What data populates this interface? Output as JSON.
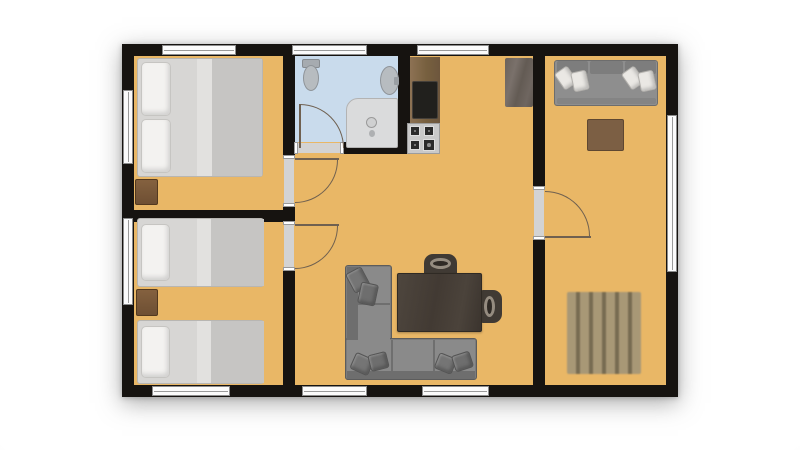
{
  "canvas": {
    "width": 800,
    "height": 450,
    "background": "#ffffff"
  },
  "palette": {
    "wall": "#161310",
    "floor": "#e9b766",
    "bathroom_floor": "#c9dbec",
    "door_line": "#6f6050",
    "window_fill": "#fbfbfb",
    "window_frame": "#8c8c8c",
    "sofa_gray": "#7c7c7c",
    "bed_gray": "#d7d6d4",
    "wood_brown": "#7c5f44"
  },
  "rooms": [
    "bedroom-double",
    "bedroom-twin",
    "bathroom",
    "kitchen-living-room",
    "lounge-room"
  ],
  "elements": [
    {
      "n": "outer-wall",
      "x": 122,
      "y": 44,
      "w": 556,
      "h": 353,
      "bg": "#161310",
      "cls": "plan-shadow"
    },
    {
      "n": "floor",
      "x": 134,
      "y": 56,
      "w": 532,
      "h": 329,
      "bg": "#e9b766"
    },
    {
      "n": "bathroom-floor",
      "x": 295,
      "y": 56,
      "w": 103,
      "h": 86,
      "bg": "#c9dbec"
    },
    {
      "n": "wall-bedrooms-top-seg",
      "x": 283,
      "y": 56,
      "w": 12,
      "h": 101,
      "bg": "#161310"
    },
    {
      "n": "wall-bedrooms-mid-seg",
      "x": 283,
      "y": 205,
      "w": 12,
      "h": 18,
      "bg": "#161310"
    },
    {
      "n": "wall-bedrooms-bottom-seg",
      "x": 283,
      "y": 269,
      "w": 12,
      "h": 116,
      "bg": "#161310"
    },
    {
      "n": "wall-bedroom-divider",
      "x": 134,
      "y": 210,
      "w": 149,
      "h": 12,
      "bg": "#161310"
    },
    {
      "n": "wall-bathroom-right",
      "x": 398,
      "y": 56,
      "w": 12,
      "h": 98,
      "bg": "#161310"
    },
    {
      "n": "wall-bathroom-bottom",
      "x": 342,
      "y": 142,
      "w": 56,
      "h": 12,
      "bg": "#161310"
    },
    {
      "n": "wall-lounge-top-seg",
      "x": 533,
      "y": 56,
      "w": 12,
      "h": 131,
      "bg": "#161310"
    },
    {
      "n": "wall-lounge-bottom-seg",
      "x": 533,
      "y": 240,
      "w": 12,
      "h": 145,
      "bg": "#161310"
    },
    {
      "n": "window-top-bedroom1",
      "x": 162,
      "y": 45,
      "w": 74,
      "h": 10,
      "cls": "window-h"
    },
    {
      "n": "window-top-bathroom",
      "x": 292,
      "y": 45,
      "w": 75,
      "h": 10,
      "cls": "window-h"
    },
    {
      "n": "window-top-kitchen",
      "x": 417,
      "y": 45,
      "w": 72,
      "h": 10,
      "cls": "window-h"
    },
    {
      "n": "window-bottom-bedroom2",
      "x": 152,
      "y": 386,
      "w": 78,
      "h": 10,
      "cls": "window-h"
    },
    {
      "n": "window-bottom-living-1",
      "x": 302,
      "y": 386,
      "w": 65,
      "h": 10,
      "cls": "window-h"
    },
    {
      "n": "window-bottom-living-2",
      "x": 422,
      "y": 386,
      "w": 67,
      "h": 10,
      "cls": "window-h"
    },
    {
      "n": "window-left-bedroom1",
      "x": 123,
      "y": 90,
      "w": 10,
      "h": 74,
      "cls": "window-v"
    },
    {
      "n": "window-left-bedroom2",
      "x": 123,
      "y": 218,
      "w": 10,
      "h": 87,
      "cls": "window-v"
    },
    {
      "n": "window-right-lounge",
      "x": 667,
      "y": 115,
      "w": 10,
      "h": 157,
      "cls": "window-v"
    },
    {
      "n": "door-opening-bathroom",
      "x": 296,
      "y": 143,
      "w": 46,
      "h": 10,
      "cls": "opening-h"
    },
    {
      "n": "door-opening-bedroom1",
      "x": 284,
      "y": 157,
      "w": 10,
      "h": 48,
      "cls": "opening-v"
    },
    {
      "n": "door-opening-bedroom2",
      "x": 284,
      "y": 223,
      "w": 10,
      "h": 46,
      "cls": "opening-v"
    },
    {
      "n": "door-opening-lounge",
      "x": 534,
      "y": 188,
      "w": 10,
      "h": 50,
      "cls": "opening-v"
    },
    {
      "n": "door-leaf-bathroom",
      "x": 299,
      "y": 104,
      "w": 2,
      "h": 44,
      "bg": "#6f6050"
    },
    {
      "n": "door-arc-bathroom",
      "x": 300,
      "y": 104,
      "w": 44,
      "h": 44,
      "corner": "tr"
    },
    {
      "n": "door-leaf-bedroom1",
      "x": 295,
      "y": 158,
      "w": 44,
      "h": 2,
      "bg": "#6f6050"
    },
    {
      "n": "door-arc-bedroom1",
      "x": 295,
      "y": 160,
      "w": 43,
      "h": 43,
      "corner": "br"
    },
    {
      "n": "door-leaf-bedroom2",
      "x": 295,
      "y": 224,
      "w": 44,
      "h": 2,
      "bg": "#6f6050"
    },
    {
      "n": "door-arc-bedroom2",
      "x": 295,
      "y": 226,
      "w": 43,
      "h": 43,
      "corner": "br"
    },
    {
      "n": "door-leaf-lounge",
      "x": 545,
      "y": 236,
      "w": 46,
      "h": 2,
      "bg": "#6f6050"
    },
    {
      "n": "door-arc-lounge",
      "x": 545,
      "y": 191,
      "w": 45,
      "h": 45,
      "corner": "tr"
    },
    {
      "n": "double-bed-base",
      "x": 137,
      "y": 58,
      "w": 126,
      "h": 119,
      "bg": "#d7d6d4",
      "br": "#b8b6b2",
      "r": 3
    },
    {
      "n": "double-bed-duvet",
      "x": 197,
      "y": 59,
      "w": 65,
      "h": 117,
      "bg": "#c6c5c3"
    },
    {
      "n": "double-bed-fold",
      "x": 197,
      "y": 59,
      "w": 15,
      "h": 117,
      "bg": "#e2e1df"
    },
    {
      "n": "double-bed-pillow-top",
      "x": 141,
      "y": 62,
      "w": 30,
      "h": 54,
      "cls": "pillow"
    },
    {
      "n": "double-bed-pillow-bottom",
      "x": 141,
      "y": 119,
      "w": 30,
      "h": 54,
      "cls": "pillow"
    },
    {
      "n": "nightstand-bedroom1",
      "x": 135,
      "y": 179,
      "w": 23,
      "h": 26,
      "cls": "wood-small"
    },
    {
      "n": "twin-bed-a-base",
      "x": 137,
      "y": 218,
      "w": 127,
      "h": 69,
      "bg": "#d7d6d4",
      "br": "#b8b6b2",
      "r": 3
    },
    {
      "n": "twin-bed-a-duvet",
      "x": 197,
      "y": 219,
      "w": 67,
      "h": 67,
      "bg": "#c6c5c3"
    },
    {
      "n": "twin-bed-a-fold",
      "x": 197,
      "y": 219,
      "w": 14,
      "h": 67,
      "bg": "#e2e1df"
    },
    {
      "n": "twin-bed-a-pillow",
      "x": 141,
      "y": 224,
      "w": 29,
      "h": 57,
      "cls": "pillow"
    },
    {
      "n": "nightstand-bedroom2",
      "x": 136,
      "y": 289,
      "w": 22,
      "h": 27,
      "cls": "wood-small"
    },
    {
      "n": "twin-bed-b-base",
      "x": 137,
      "y": 320,
      "w": 127,
      "h": 64,
      "bg": "#d7d6d4",
      "br": "#b8b6b2",
      "r": 3
    },
    {
      "n": "twin-bed-b-duvet",
      "x": 197,
      "y": 321,
      "w": 67,
      "h": 62,
      "bg": "#c6c5c3"
    },
    {
      "n": "twin-bed-b-fold",
      "x": 197,
      "y": 321,
      "w": 14,
      "h": 62,
      "bg": "#e2e1df"
    },
    {
      "n": "twin-bed-b-pillow",
      "x": 141,
      "y": 326,
      "w": 29,
      "h": 52,
      "cls": "pillow"
    },
    {
      "n": "toilet-tank",
      "x": 302,
      "y": 59,
      "w": 18,
      "h": 9,
      "bg": "#a6abb0",
      "br": "#878c91",
      "r": 2
    },
    {
      "n": "toilet-bowl",
      "x": 303,
      "y": 65,
      "w": 16,
      "h": 26,
      "bg": "#b7bcc0",
      "br": "#8e9398",
      "sh": "e"
    },
    {
      "n": "bathroom-sink",
      "x": 380,
      "y": 66,
      "w": 19,
      "h": 29,
      "bg": "#b7bcc0",
      "br": "#8e9398",
      "sh": "e"
    },
    {
      "n": "sink-tap",
      "x": 394,
      "y": 77,
      "w": 5,
      "h": 8,
      "bg": "#999ea3",
      "r": 1
    },
    {
      "n": "shower-tray",
      "x": 346,
      "y": 98,
      "w": 52,
      "h": 50,
      "bg": "#dadbdc",
      "br": "#b3b3b3",
      "r": "12px 2px 2px 2px"
    },
    {
      "n": "shower-drain",
      "x": 366,
      "y": 117,
      "w": 11,
      "h": 11,
      "bg": "#cfd0d1",
      "br": "#9a9a9a",
      "sh": "e"
    },
    {
      "n": "shower-hose-dot",
      "x": 369,
      "y": 130,
      "w": 6,
      "h": 7,
      "bg": "#aeb0b2",
      "sh": "e"
    },
    {
      "n": "kitchen-counter",
      "x": 410,
      "y": 57,
      "w": 30,
      "h": 66,
      "cls": "wood-v"
    },
    {
      "n": "kitchen-sink",
      "x": 412,
      "y": 81,
      "w": 26,
      "h": 38,
      "bg": "#21201d",
      "br": "#45403a",
      "r": 2
    },
    {
      "n": "kitchen-stove",
      "x": 407,
      "y": 123,
      "w": 33,
      "h": 31,
      "bg": "#c9c9c9",
      "br": "#9c9c9c"
    },
    {
      "n": "stove-burner-1",
      "x": 410,
      "y": 126,
      "w": 10,
      "h": 10,
      "bg": "#2b2b2b",
      "cls": "burner"
    },
    {
      "n": "stove-burner-2",
      "x": 424,
      "y": 126,
      "w": 10,
      "h": 10,
      "bg": "#2b2b2b",
      "cls": "burner"
    },
    {
      "n": "stove-burner-3",
      "x": 410,
      "y": 140,
      "w": 10,
      "h": 10,
      "bg": "#2b2b2b",
      "cls": "burner"
    },
    {
      "n": "stove-burner-4",
      "x": 423,
      "y": 139,
      "w": 12,
      "h": 12,
      "bg": "#2b2b2b",
      "cls": "burner"
    },
    {
      "n": "tall-cabinet",
      "x": 505,
      "y": 58,
      "w": 28,
      "h": 49,
      "cls": "mottle"
    },
    {
      "n": "lounge-sofa-base",
      "x": 554,
      "y": 60,
      "w": 104,
      "h": 46,
      "bg": "#8e8e8e",
      "br": "#6d6d6d",
      "r": 3
    },
    {
      "n": "lounge-sofa-back-1",
      "x": 557,
      "y": 61,
      "w": 31,
      "h": 13,
      "bg": "#7d7d7d",
      "r": 2
    },
    {
      "n": "lounge-sofa-back-2",
      "x": 590,
      "y": 61,
      "w": 33,
      "h": 13,
      "bg": "#7d7d7d",
      "r": 2
    },
    {
      "n": "lounge-sofa-back-3",
      "x": 625,
      "y": 61,
      "w": 31,
      "h": 13,
      "bg": "#7d7d7d",
      "r": 2
    },
    {
      "n": "lounge-sofa-seat-edge",
      "x": 557,
      "y": 98,
      "w": 99,
      "h": 6,
      "bg": "#848484",
      "r": 2
    },
    {
      "n": "lounge-sofa-pillow-1",
      "x": 558,
      "y": 68,
      "w": 16,
      "h": 20,
      "rot": -35,
      "cls": "pillow-small"
    },
    {
      "n": "lounge-sofa-pillow-2",
      "x": 572,
      "y": 71,
      "w": 16,
      "h": 20,
      "rot": -12,
      "cls": "pillow-small"
    },
    {
      "n": "lounge-sofa-pillow-3",
      "x": 625,
      "y": 68,
      "w": 16,
      "h": 20,
      "rot": -35,
      "cls": "pillow-small"
    },
    {
      "n": "lounge-sofa-pillow-4",
      "x": 639,
      "y": 71,
      "w": 16,
      "h": 20,
      "rot": -12,
      "cls": "pillow-small"
    },
    {
      "n": "lounge-coffee-table",
      "x": 587,
      "y": 119,
      "w": 37,
      "h": 32,
      "bg": "#7c5f44",
      "br": "#5e4731",
      "cls": "planks-h"
    },
    {
      "n": "lounge-pallet-table",
      "x": 567,
      "y": 292,
      "w": 74,
      "h": 82,
      "cls": "slats"
    },
    {
      "n": "corner-sofa-vertical",
      "x": 345,
      "y": 265,
      "w": 47,
      "h": 115,
      "bg": "#7c7c7c",
      "br": "#5c5c5c",
      "r": 3
    },
    {
      "n": "corner-sofa-horizontal",
      "x": 345,
      "y": 338,
      "w": 132,
      "h": 42,
      "bg": "#7c7c7c",
      "br": "#5c5c5c",
      "r": 3
    },
    {
      "n": "corner-sofa-back-left",
      "x": 347,
      "y": 267,
      "w": 11,
      "h": 111,
      "bg": "#6e6e6e"
    },
    {
      "n": "corner-sofa-seat-vertical",
      "x": 358,
      "y": 267,
      "w": 32,
      "h": 111,
      "bg": "#8a8a8a"
    },
    {
      "n": "corner-sofa-seat-horizontal",
      "x": 347,
      "y": 340,
      "w": 128,
      "h": 31,
      "bg": "#8a8a8a"
    },
    {
      "n": "corner-sofa-back-bottom",
      "x": 347,
      "y": 371,
      "w": 128,
      "h": 8,
      "bg": "#6e6e6e"
    },
    {
      "n": "corner-sofa-seam-1",
      "x": 358,
      "y": 303,
      "w": 32,
      "h": 2,
      "bg": "#6f6f6f"
    },
    {
      "n": "corner-sofa-seam-2",
      "x": 391,
      "y": 340,
      "w": 2,
      "h": 31,
      "bg": "#6f6f6f"
    },
    {
      "n": "corner-sofa-seam-3",
      "x": 433,
      "y": 340,
      "w": 2,
      "h": 31,
      "bg": "#6f6f6f"
    },
    {
      "n": "corner-sofa-pillow-1",
      "x": 349,
      "y": 269,
      "w": 18,
      "h": 22,
      "rot": -28,
      "bg": "#757575",
      "br": "#555555",
      "cls": "pillow-dark"
    },
    {
      "n": "corner-sofa-pillow-2",
      "x": 359,
      "y": 283,
      "w": 18,
      "h": 22,
      "rot": 12,
      "bg": "#6e6e6e",
      "br": "#545454",
      "cls": "pillow-dark"
    },
    {
      "n": "corner-sofa-pillow-3",
      "x": 352,
      "y": 355,
      "w": 20,
      "h": 18,
      "rot": 24,
      "bg": "#757575",
      "br": "#555555",
      "cls": "pillow-dark"
    },
    {
      "n": "corner-sofa-pillow-4",
      "x": 369,
      "y": 353,
      "w": 19,
      "h": 17,
      "rot": -14,
      "bg": "#6e6e6e",
      "br": "#545454",
      "cls": "pillow-dark"
    },
    {
      "n": "corner-sofa-pillow-5",
      "x": 436,
      "y": 355,
      "w": 19,
      "h": 17,
      "rot": 22,
      "bg": "#757575",
      "br": "#555555",
      "cls": "pillow-dark"
    },
    {
      "n": "corner-sofa-pillow-6",
      "x": 453,
      "y": 353,
      "w": 19,
      "h": 17,
      "rot": -18,
      "bg": "#6e6e6e",
      "br": "#545454",
      "cls": "pillow-dark"
    },
    {
      "n": "desk-chair-top",
      "x": 424,
      "y": 254,
      "w": 33,
      "h": 22,
      "bg": "#403a34",
      "r": "9px 9px 3px 3px"
    },
    {
      "n": "desk-chair-top-handle",
      "x": 430,
      "y": 258,
      "w": 21,
      "h": 11,
      "cls": "ring2"
    },
    {
      "n": "desk-chair-right",
      "x": 480,
      "y": 290,
      "w": 22,
      "h": 33,
      "bg": "#403a34",
      "r": "3px 9px 9px 3px"
    },
    {
      "n": "desk-chair-right-handle",
      "x": 484,
      "y": 296,
      "w": 11,
      "h": 21,
      "cls": "ring2"
    },
    {
      "n": "desk",
      "x": 397,
      "y": 273,
      "w": 85,
      "h": 59,
      "cls": "wood-dark"
    }
  ]
}
